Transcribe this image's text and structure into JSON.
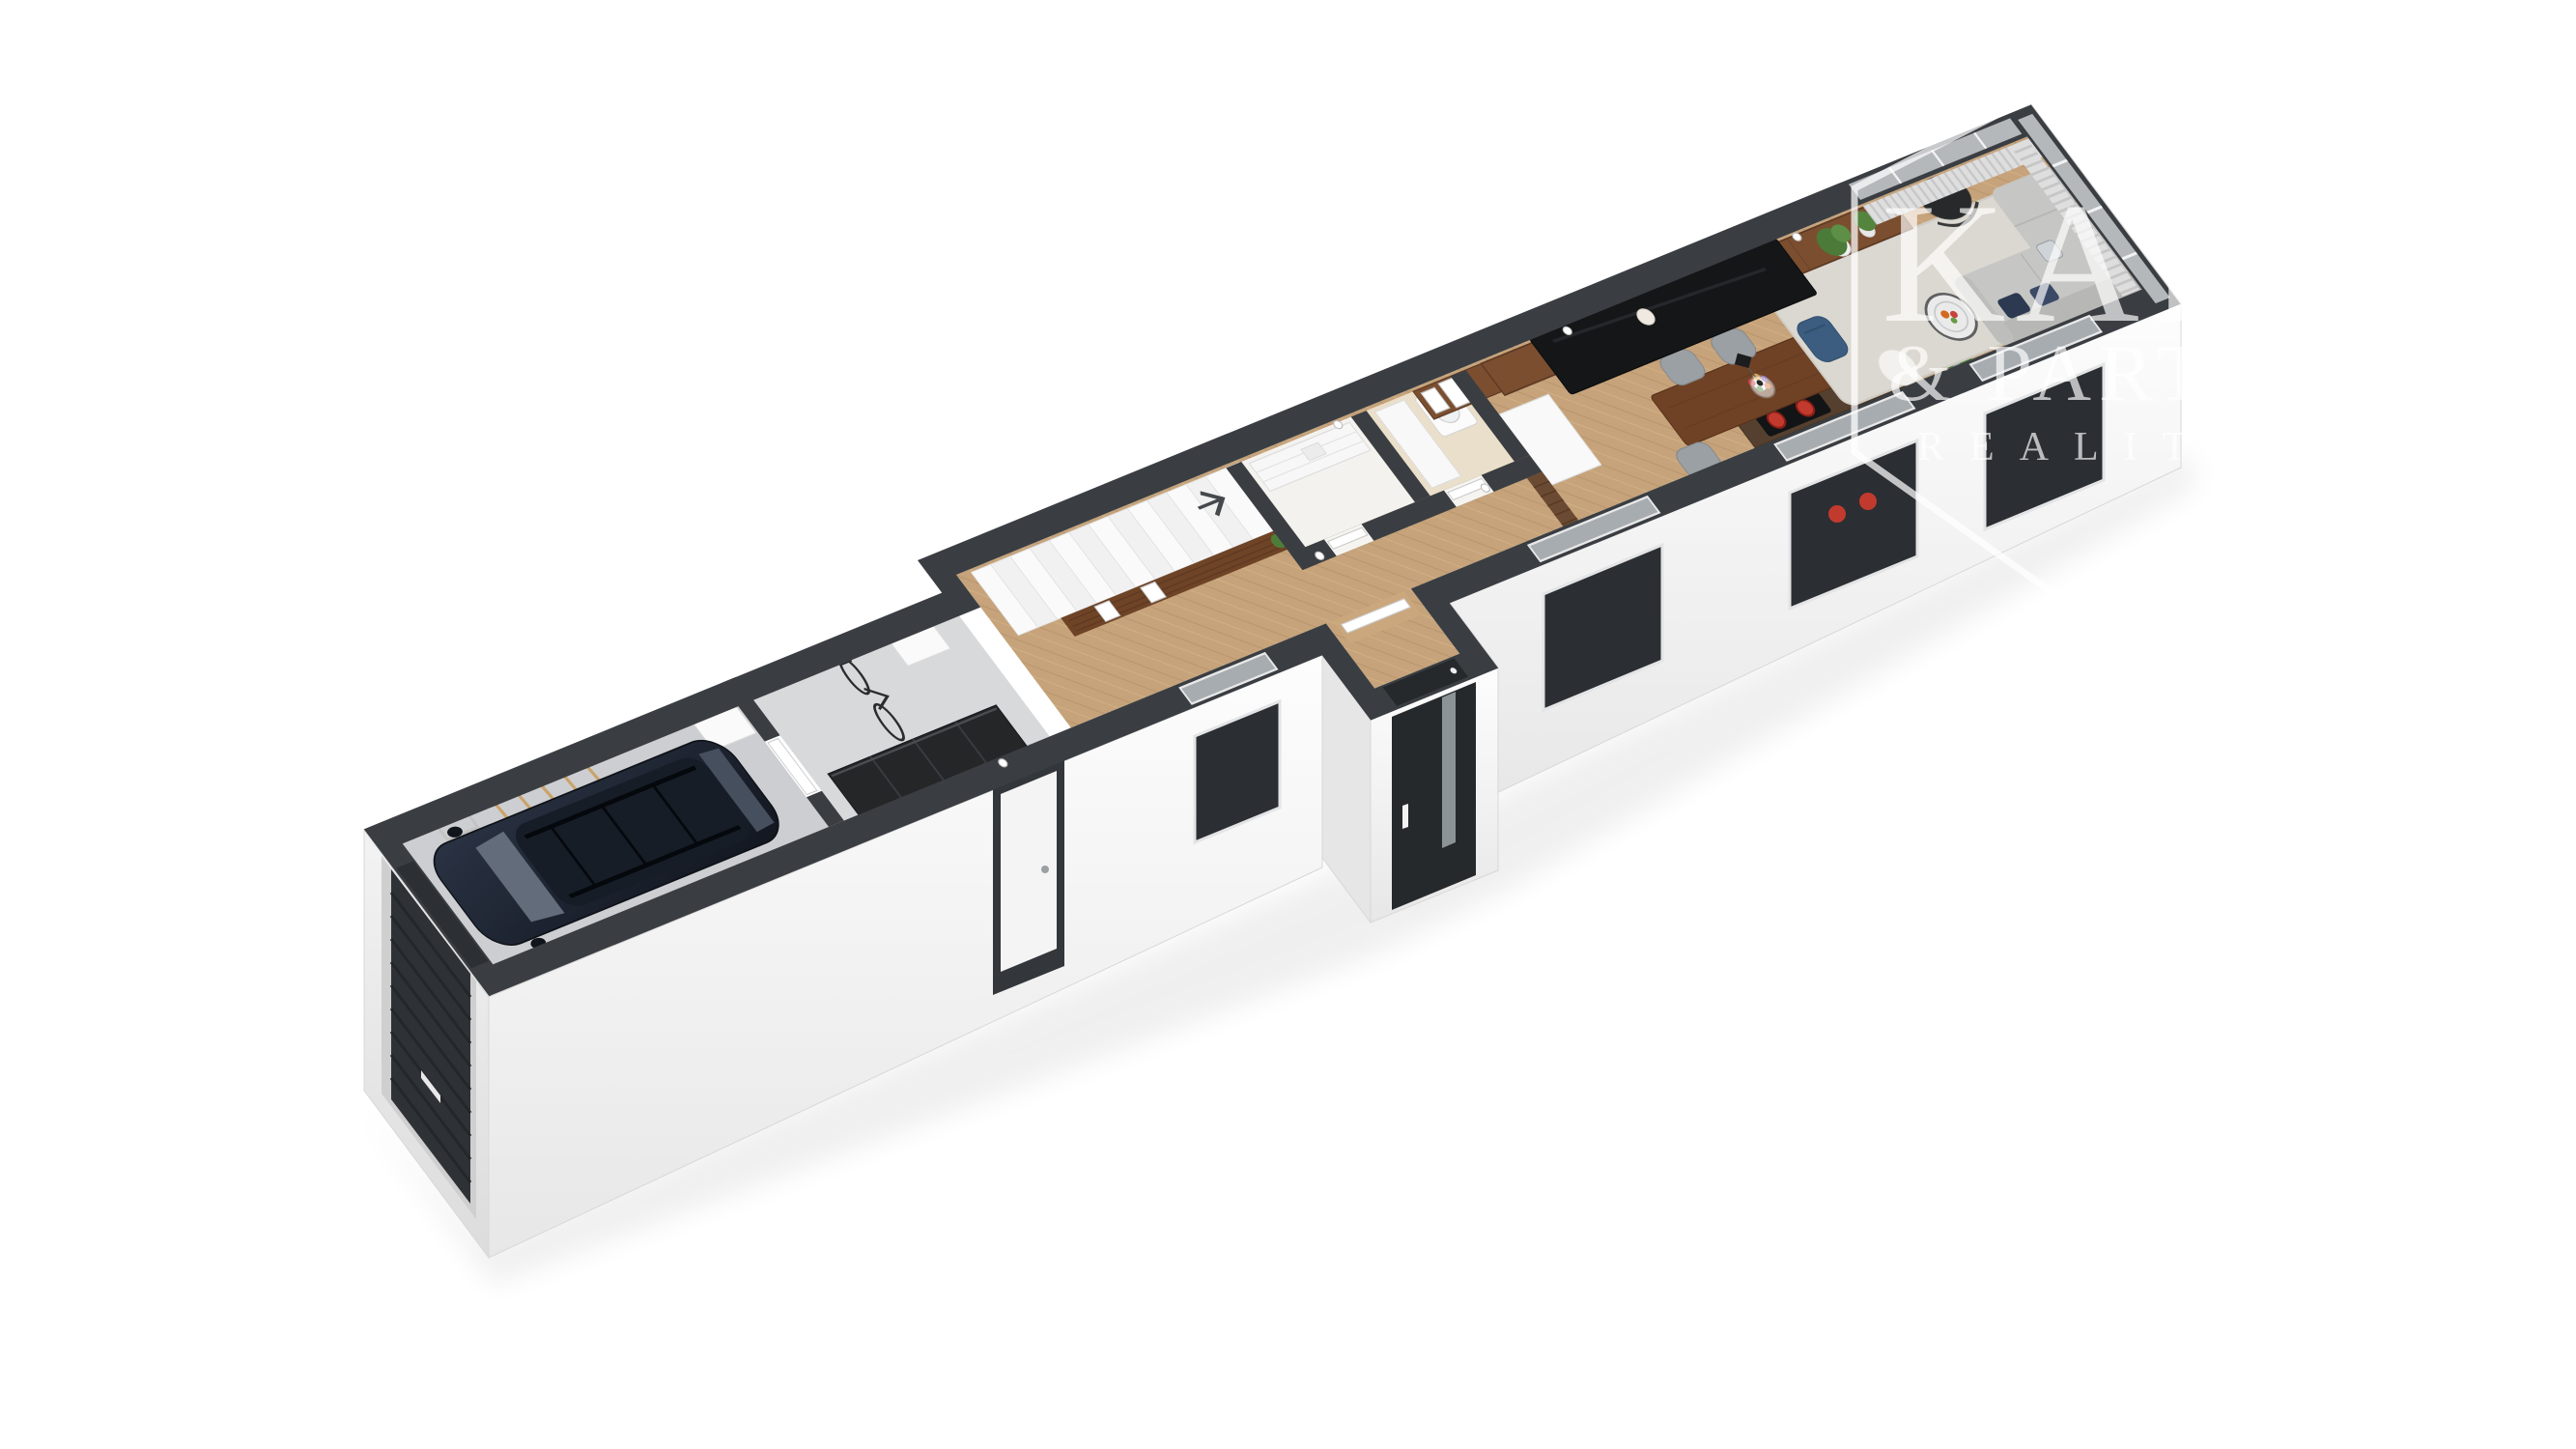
{
  "meta": {
    "title": "3D ground-floor cutaway floor plan render",
    "projection": "axonometric-perspective",
    "background": "#ffffff"
  },
  "watermark": {
    "line1": "KAR",
    "line2": "& PART",
    "line3": "REALITN",
    "badge": "hexagon-outline",
    "color": "rgba(255,255,255,0.68)"
  },
  "palette": {
    "wall_top": "#3a3e42",
    "wall_face_light": "#fdfdfd",
    "wall_face_shade": "#e7e7e7",
    "wood_floor": "#c6a37a",
    "walnut_furniture": "#6f4226",
    "tv_console": "#7b4e2f",
    "garage_floor": "#cdced1",
    "utility_floor": "#d8d9db",
    "bathroom_floor": "#eadfcb",
    "rug": "#dbd8d1",
    "sofa": "#c6c6c4",
    "accent_chair_blue": "#3c5d80",
    "plant_green": "#4a7a37",
    "cooktop_burner_red": "#c23a2e",
    "car_body": "#1a2130",
    "front_door": "#26292c",
    "garage_door": "#2e3236",
    "glass": "#b4b8bb"
  },
  "rooms": [
    {
      "name": "garage",
      "floor": "concrete",
      "items": [
        "suv-car",
        "bicycle",
        "tool-rack",
        "ladder",
        "storage-box",
        "garage-door"
      ]
    },
    {
      "name": "utility-room",
      "floor": "concrete",
      "items": [
        "black-shelving",
        "white-cabinet",
        "exterior-door"
      ]
    },
    {
      "name": "hallway",
      "floor": "herringbone-wood",
      "items": [
        "staircase",
        "stair-direction-arrow",
        "wood-feature-wall",
        "picture-frames"
      ]
    },
    {
      "name": "pantry",
      "floor": "light",
      "items": [
        "white-shelving"
      ]
    },
    {
      "name": "bathroom",
      "floor": "beige",
      "items": [
        "tall-cabinet",
        "washing-machine"
      ]
    },
    {
      "name": "entry-vestibule",
      "floor": "herringbone-wood",
      "items": [
        "front-door-black-glass"
      ]
    },
    {
      "name": "kitchen",
      "floor": "herringbone-wood",
      "items": [
        "counter",
        "cooktop-red-burners",
        "window"
      ]
    },
    {
      "name": "dining-area",
      "floor": "herringbone-wood",
      "items": [
        "dining-table",
        "grey-chairs",
        "pendant-lamp",
        "flower-bouquet",
        "potted-plant",
        "tall-white-cabinet"
      ]
    },
    {
      "name": "living-room",
      "floor": "herringbone-wood",
      "items": [
        "wall-tv",
        "tv-console",
        "sheer-curtains",
        "corner-sofa",
        "hanging-chair",
        "blue-armchair",
        "round-coffee-table",
        "pouf",
        "area-rug",
        "plants",
        "wall-art-frames"
      ]
    }
  ],
  "indicators": {
    "stairs_direction_icon": "chevron-up-stairs"
  }
}
